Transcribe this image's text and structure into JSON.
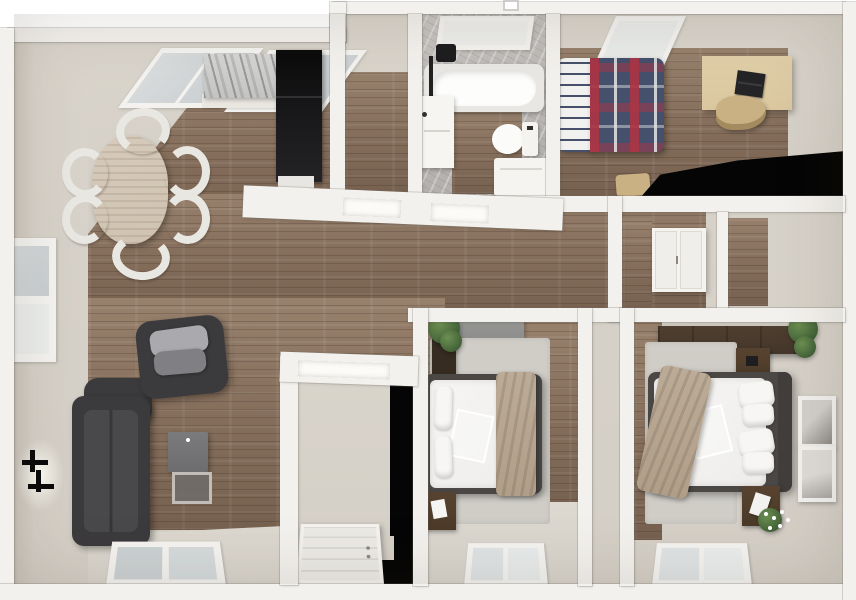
{
  "scene": {
    "title": "3D apartment floor plan - top-down render",
    "view": "top-down-3d-render",
    "width_px": 856,
    "height_px": 600
  },
  "colors": {
    "wall": "#f3f1ed",
    "beige_floor": "#d9d4cb",
    "beige_wall": "#cdc7bd",
    "wood_base": "#87705d",
    "wood_dark": "#76604f",
    "wood_light": "#97816d",
    "marble_wall": "#aeaba8",
    "marble_counter": "#c3c3c1",
    "glass": "#d9dcdd",
    "black": "#050505",
    "sofa_dark": "#3b3a3c",
    "sofa_seat": "#49484a",
    "pillow_light": "#aaaaae",
    "pillow_mid": "#808084",
    "table_wood": "#cfc2b0",
    "chair_white": "#e9e7e2",
    "desk_wood": "#dac79f",
    "tan_chair": "#c9b183",
    "plaid_navy": "#44506c",
    "plaid_red": "#ab3544",
    "plaid_gray": "#9aa2ac",
    "sheet_white": "#f1f1f0",
    "duvet_white": "#eeedeb",
    "throw_tan": "#b09e88",
    "bed_frame": "#4a4745",
    "wardrobe_brown": "#44362a",
    "nightstand_brown": "#4c3a29",
    "rug_gray": "#d0cdc7",
    "dresser_gray": "#8c8c8a",
    "plant_green": "#46663a",
    "door_white": "#eceae5",
    "tub_white": "#fdfdfc",
    "fixture_black": "#1d1d1f"
  },
  "rooms": [
    {
      "id": "kitchen-dining",
      "label": "Kitchen / Dining",
      "floor": "wood",
      "furniture": [
        "kitchen-counter-marble",
        "refrigerator",
        "skylight",
        "skylight",
        "dining-table-oval",
        "dining-chairs-x6"
      ]
    },
    {
      "id": "storage-room",
      "label": "Storage Room",
      "floor": "wood",
      "furniture": []
    },
    {
      "id": "bathroom",
      "label": "Bathroom",
      "floor": "wood-and-marble",
      "furniture": [
        "skylight",
        "bathtub",
        "shower-fixture",
        "vanity-sink",
        "toilet",
        "washer-cabinet"
      ]
    },
    {
      "id": "bedroom-1",
      "label": "Bedroom 1",
      "floor": "wood",
      "furniture": [
        "single-bed-plaid",
        "skylight",
        "desk",
        "laptop",
        "desk-chair",
        "stool"
      ]
    },
    {
      "id": "hallway",
      "label": "Hallway",
      "floor": "wood",
      "furniture": [
        "wall-cabinet-double-door"
      ]
    },
    {
      "id": "living-room",
      "label": "Living Room",
      "floor": "wood",
      "furniture": [
        "sofa",
        "armchair",
        "cushion",
        "cushion",
        "side-table",
        "wall-sconce",
        "window"
      ]
    },
    {
      "id": "entry",
      "label": "Entry",
      "floor": "beige",
      "furniture": [
        "front-door"
      ]
    },
    {
      "id": "bedroom-2",
      "label": "Bedroom 2",
      "floor": "wood-and-beige",
      "furniture": [
        "double-bed",
        "nightstand",
        "dresser",
        "plant",
        "rug",
        "window"
      ]
    },
    {
      "id": "bedroom-3",
      "label": "Bedroom 3",
      "floor": "beige",
      "furniture": [
        "double-bed",
        "wardrobe",
        "nightstand",
        "nightstand",
        "plant",
        "flower-vase",
        "wall-art",
        "wall-art",
        "rug",
        "window"
      ]
    }
  ]
}
